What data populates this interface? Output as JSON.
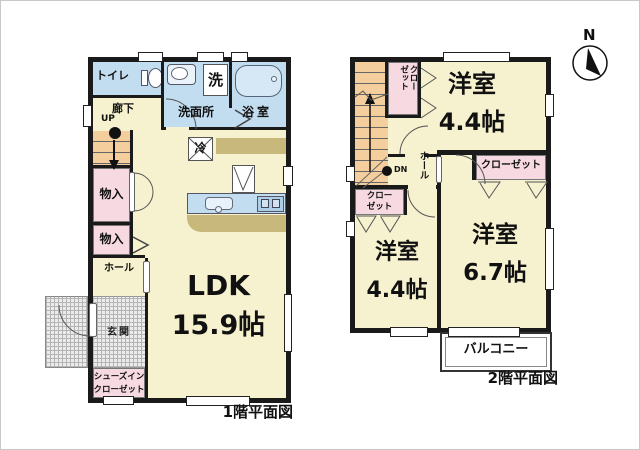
{
  "compass": {
    "north_label": "N"
  },
  "floor1": {
    "caption": "1階平面図",
    "toilet": "トイレ",
    "washing_machine": "洗",
    "washroom": "洗面所",
    "bathroom": "浴室",
    "corridor": "廊下",
    "stairs_up": "UP",
    "fridge": "冷",
    "storage_1": "物入",
    "storage_2": "物入",
    "hall": "ホール",
    "entrance": "玄関",
    "shoe_closet_line1": "シューズイン",
    "shoe_closet_line2": "クローゼット",
    "ldk_name": "LDK",
    "ldk_size": "15.9帖"
  },
  "floor2": {
    "caption": "2階平面図",
    "stairs_down": "DN",
    "closet_top_col1": "クロー",
    "closet_top_col2": "ゼット",
    "hall": "ホール",
    "closet_right": "クローゼット",
    "closet_left_line1": "クロー",
    "closet_left_line2": "ゼット",
    "bedroom_top_name": "洋室",
    "bedroom_top_size": "4.4帖",
    "bedroom_left_name": "洋室",
    "bedroom_left_size": "4.4帖",
    "bedroom_right_name": "洋室",
    "bedroom_right_size": "6.7帖",
    "balcony": "バルコニー"
  },
  "colors": {
    "wall": "#1a1a1a",
    "floor": "#f6f1ce",
    "wet_area": "#c2ddf0",
    "closet": "#f7d9e2",
    "stairs": "#f4cf9d",
    "counter": "#c8b87c",
    "entrance_hatch": "#ebebeb"
  }
}
